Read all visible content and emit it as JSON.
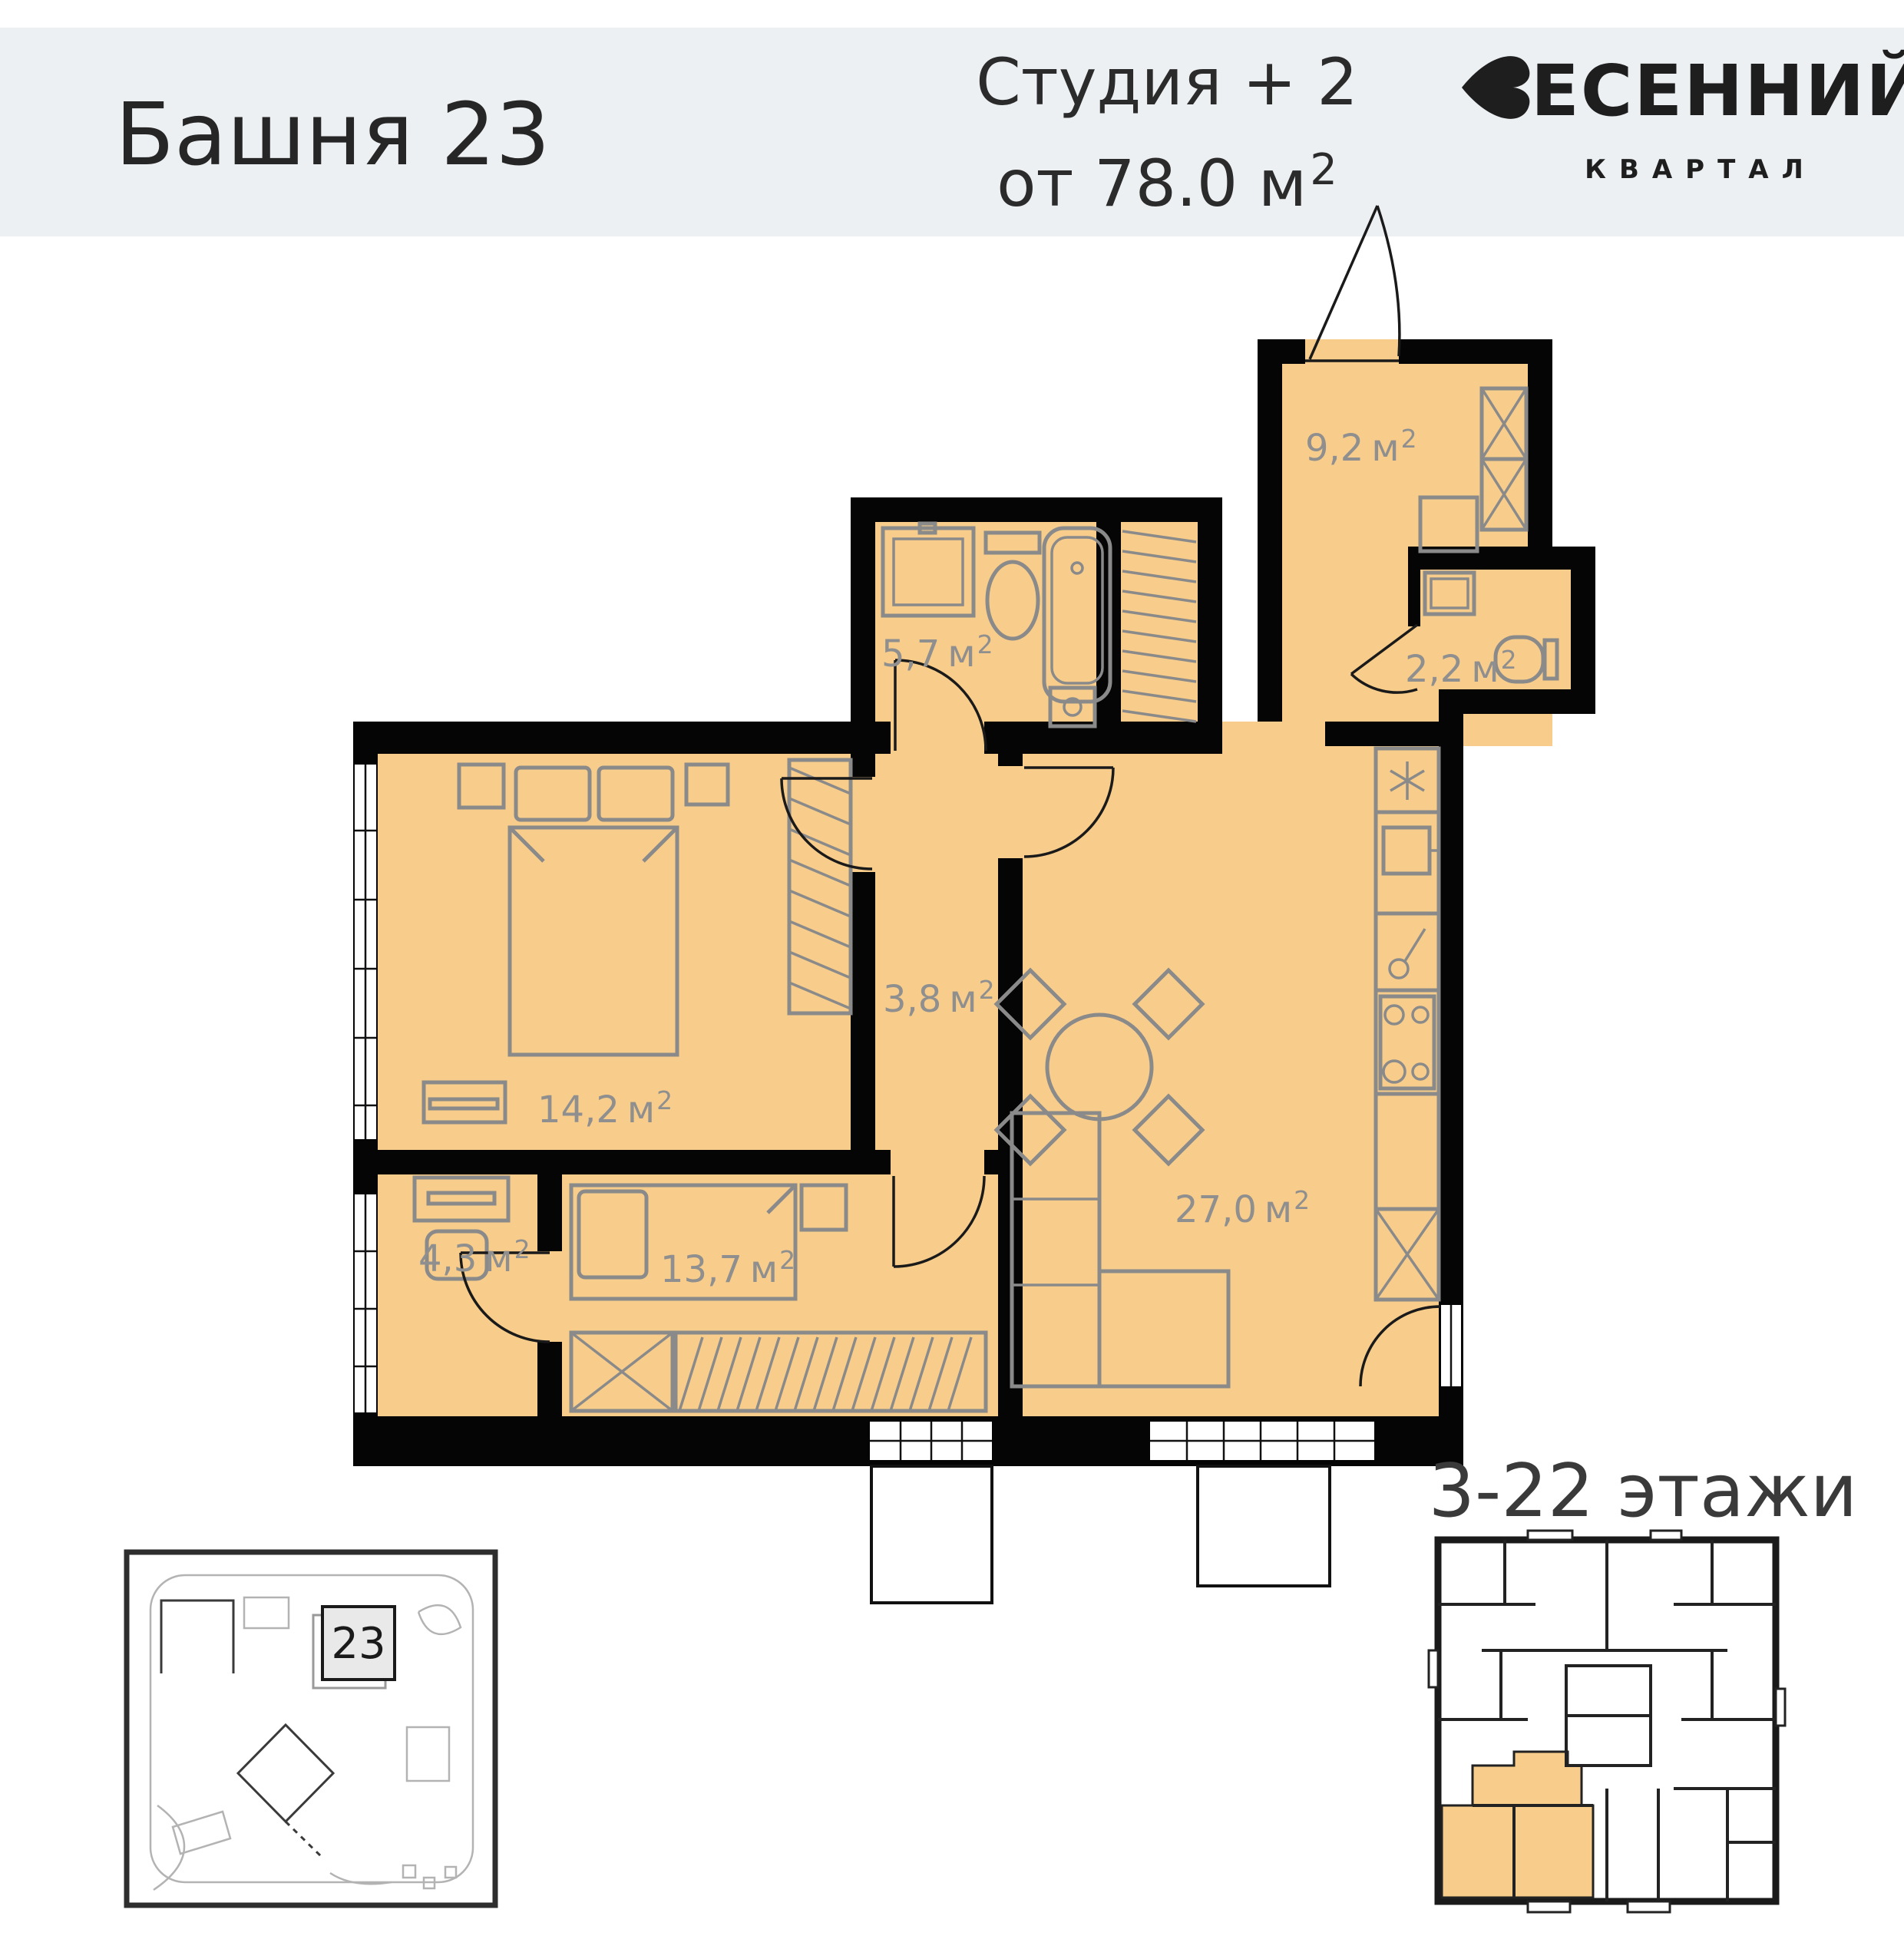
{
  "header": {
    "tower": "Башня 23",
    "type_line": "Студия + 2",
    "area_line": "от 78.0 м",
    "area_sup": "2",
    "logo_main": "ЕСЕННИЙ",
    "logo_sub": "КВАРТАЛ"
  },
  "plan": {
    "area_unit": "м",
    "area_sup": "2",
    "rooms": [
      {
        "name": "hall",
        "area": "9,2"
      },
      {
        "name": "bathroom",
        "area": "5,7"
      },
      {
        "name": "wc",
        "area": "2,2"
      },
      {
        "name": "corridor",
        "area": "3,8"
      },
      {
        "name": "bedroom",
        "area": "14,2"
      },
      {
        "name": "cabinet",
        "area": "4,3"
      },
      {
        "name": "bedroom2",
        "area": "13,7"
      },
      {
        "name": "living_kitchen",
        "area": "27,0"
      }
    ]
  },
  "footer": {
    "floors_label": "3-22 этажи",
    "site_marker": "23"
  },
  "colors": {
    "room_fill": "#f8cd8b",
    "wall": "#050505",
    "furniture": "#8a8a8a",
    "header_band": "#edf0f2",
    "label_gray": "#8f8f8f",
    "text_dark": "#262626"
  }
}
